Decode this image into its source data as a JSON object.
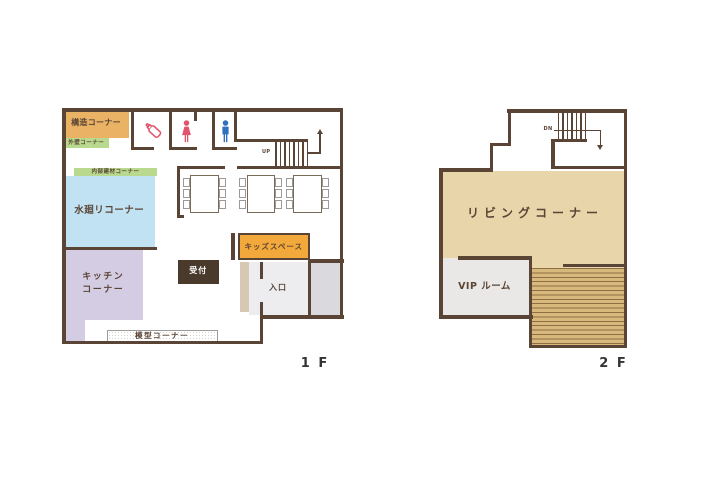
{
  "title": "Showroom floor plan",
  "colors": {
    "wall": "#5a4435",
    "orange": "#e9b265",
    "green": "#b9da8e",
    "blue": "#c1e2f3",
    "lavender": "#d3cce3",
    "reception": "#4a3a2c",
    "kids": "#f3a83b",
    "beige": "#d6c8b2",
    "entfloor": "#ededef",
    "porch": "#dadade",
    "living": "#e8d5a9",
    "vip": "#eae8e6",
    "stepsbg": "#d8b97c",
    "stepsline": "#8e6f45",
    "textbrown": "#5a4435",
    "labeldark": "#333333",
    "iconpink": "#e0556b",
    "iconblue": "#2f6fbe",
    "tableborder": "#7a6a58",
    "chairborder": "#9a9a98"
  },
  "floor1": {
    "label": "1 F",
    "rooms": {
      "structure": "構造コーナー",
      "exterior_wall": "外壁コーナー",
      "interior_materials": "内部建材コーナー",
      "water_area": "水廻リコーナー",
      "kitchen_line1": "キッチン",
      "kitchen_line2": "コーナー",
      "reception": "受付",
      "kids_space": "キッズスペース",
      "entrance": "入口",
      "model_corner": "模型コーナー"
    },
    "stairs": {
      "up_label": "UP"
    },
    "icons": [
      "nursing-bottle-icon",
      "female-restroom-icon",
      "male-restroom-icon"
    ]
  },
  "floor2": {
    "label": "2 F",
    "rooms": {
      "living": "リビングコーナー",
      "vip": "VIP ルーム"
    },
    "stairs": {
      "down_label": "DN"
    }
  }
}
